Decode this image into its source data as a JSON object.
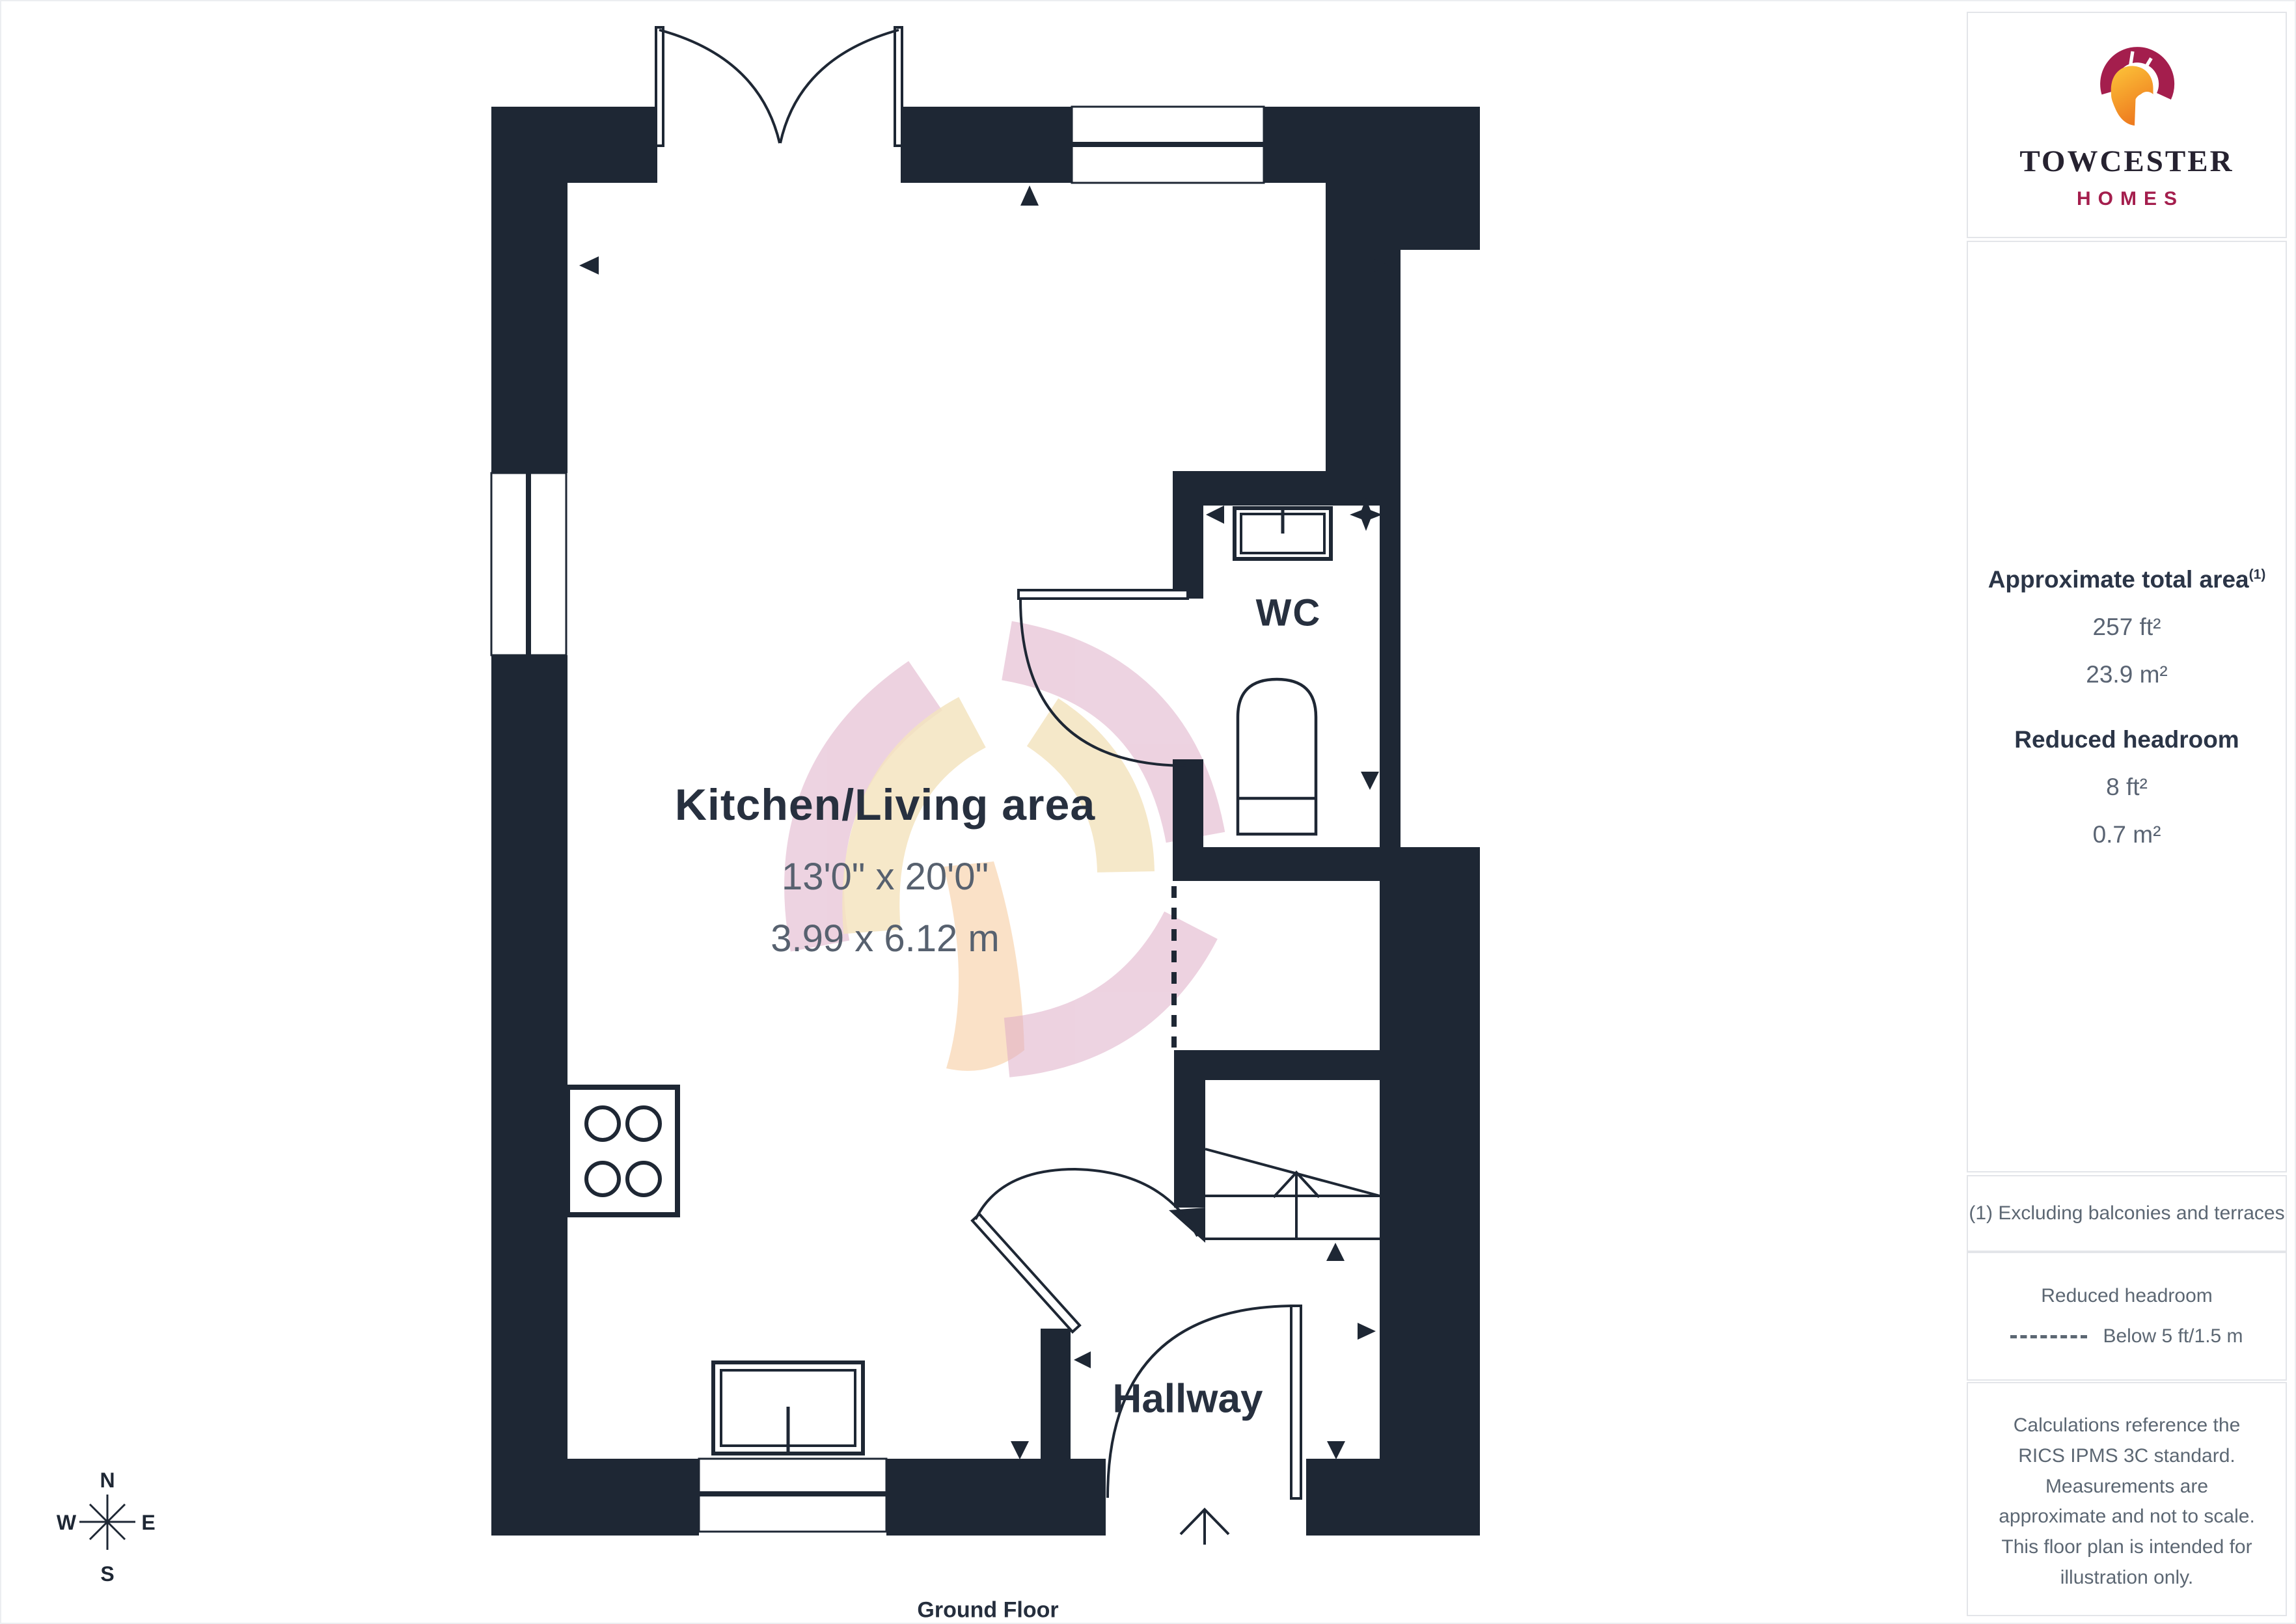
{
  "branding": {
    "name": "TOWCESTER",
    "subtitle": "HOMES"
  },
  "sidebar": {
    "area_title": "Approximate total area",
    "area_footnote_marker": "(1)",
    "area_imperial": "257 ft²",
    "area_metric": "23.9 m²",
    "headroom_title": "Reduced headroom",
    "headroom_imperial": "8 ft²",
    "headroom_metric": "0.7 m²",
    "footnote": "(1) Excluding balconies and terraces",
    "legend_title": "Reduced headroom",
    "legend_item": "Below 5 ft/1.5 m",
    "disclaimer": "Calculations reference the RICS IPMS 3C standard. Measurements are approximate and not to scale. This floor plan is intended for illustration only.",
    "brand_regular": "GIRAFFE",
    "brand_bold": "360"
  },
  "floorplan": {
    "kitchen": {
      "name": "Kitchen/Living area",
      "dims_imperial": "13'0\" x 20'0\"",
      "dims_metric": "3.99 x 6.12 m"
    },
    "wc": {
      "name": "WC"
    },
    "hallway": {
      "name": "Hallway"
    },
    "floor_label": "Ground Floor",
    "compass": {
      "north": "N",
      "south": "S",
      "east": "E",
      "west": "W"
    }
  },
  "colors": {
    "wall": "#1e2734",
    "label": "#27303f",
    "dim": "#57616f",
    "muted": "#5c6773",
    "border": "#e3e5e9",
    "crimson": "#a41e4d",
    "helm1": "#fdc53a",
    "helm2": "#ee7c1f",
    "watermark-pink": "#dfaec8",
    "watermark-cream": "#f4e4c0",
    "watermark-orange": "#f8d7b4"
  }
}
